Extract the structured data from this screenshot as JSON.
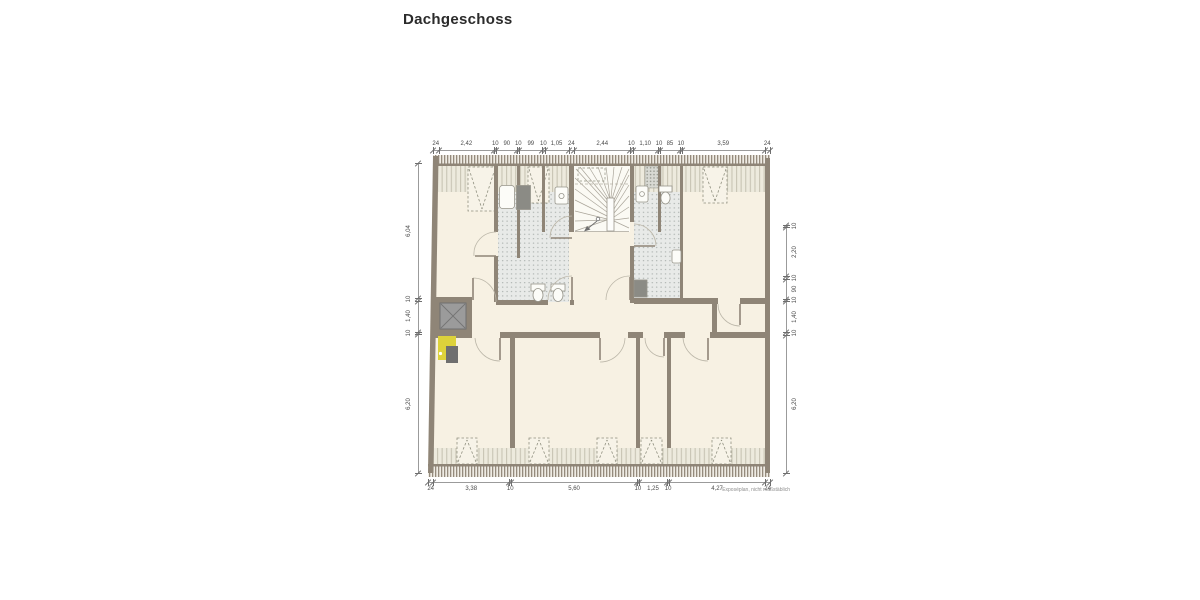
{
  "title": "Dachgeschoss",
  "footnote": "Exposéplan, nicht maßstäblich",
  "floor_plan": {
    "floor_label": "Dachgeschoss",
    "features": [
      "staircase",
      "elevator",
      "bathroom-left",
      "bathroom-right",
      "dormer-windows",
      "roof-slope-bands",
      "highlighted-unit",
      "bathtub",
      "shower",
      "toilet",
      "sink"
    ],
    "colors": {
      "wall": "#8f8577",
      "floor": "#f7f1e3",
      "tile": "#e8eae8",
      "roof_band": "#edeadd",
      "highlight": "#ddd23b",
      "elevator": "#9b9b9b"
    }
  },
  "dimensions": {
    "top": {
      "labels": [
        "24",
        "2,42",
        "10",
        "90",
        "10",
        "99",
        "10",
        "1,05",
        "24",
        "2,44",
        "10",
        "1,10",
        "10",
        "85",
        "10",
        "3,59",
        "24"
      ]
    },
    "bottom": {
      "labels": [
        "24",
        "3,38",
        "10",
        "5,60",
        "10",
        "1,25",
        "10",
        "4,27",
        "24"
      ]
    },
    "left": {
      "labels": [
        "6,04",
        "10",
        "1,40",
        "10",
        "6,20"
      ]
    },
    "right": {
      "labels": [
        "10",
        "2,20",
        "10",
        "90",
        "10",
        "1,40",
        "10",
        "6,20"
      ]
    }
  }
}
